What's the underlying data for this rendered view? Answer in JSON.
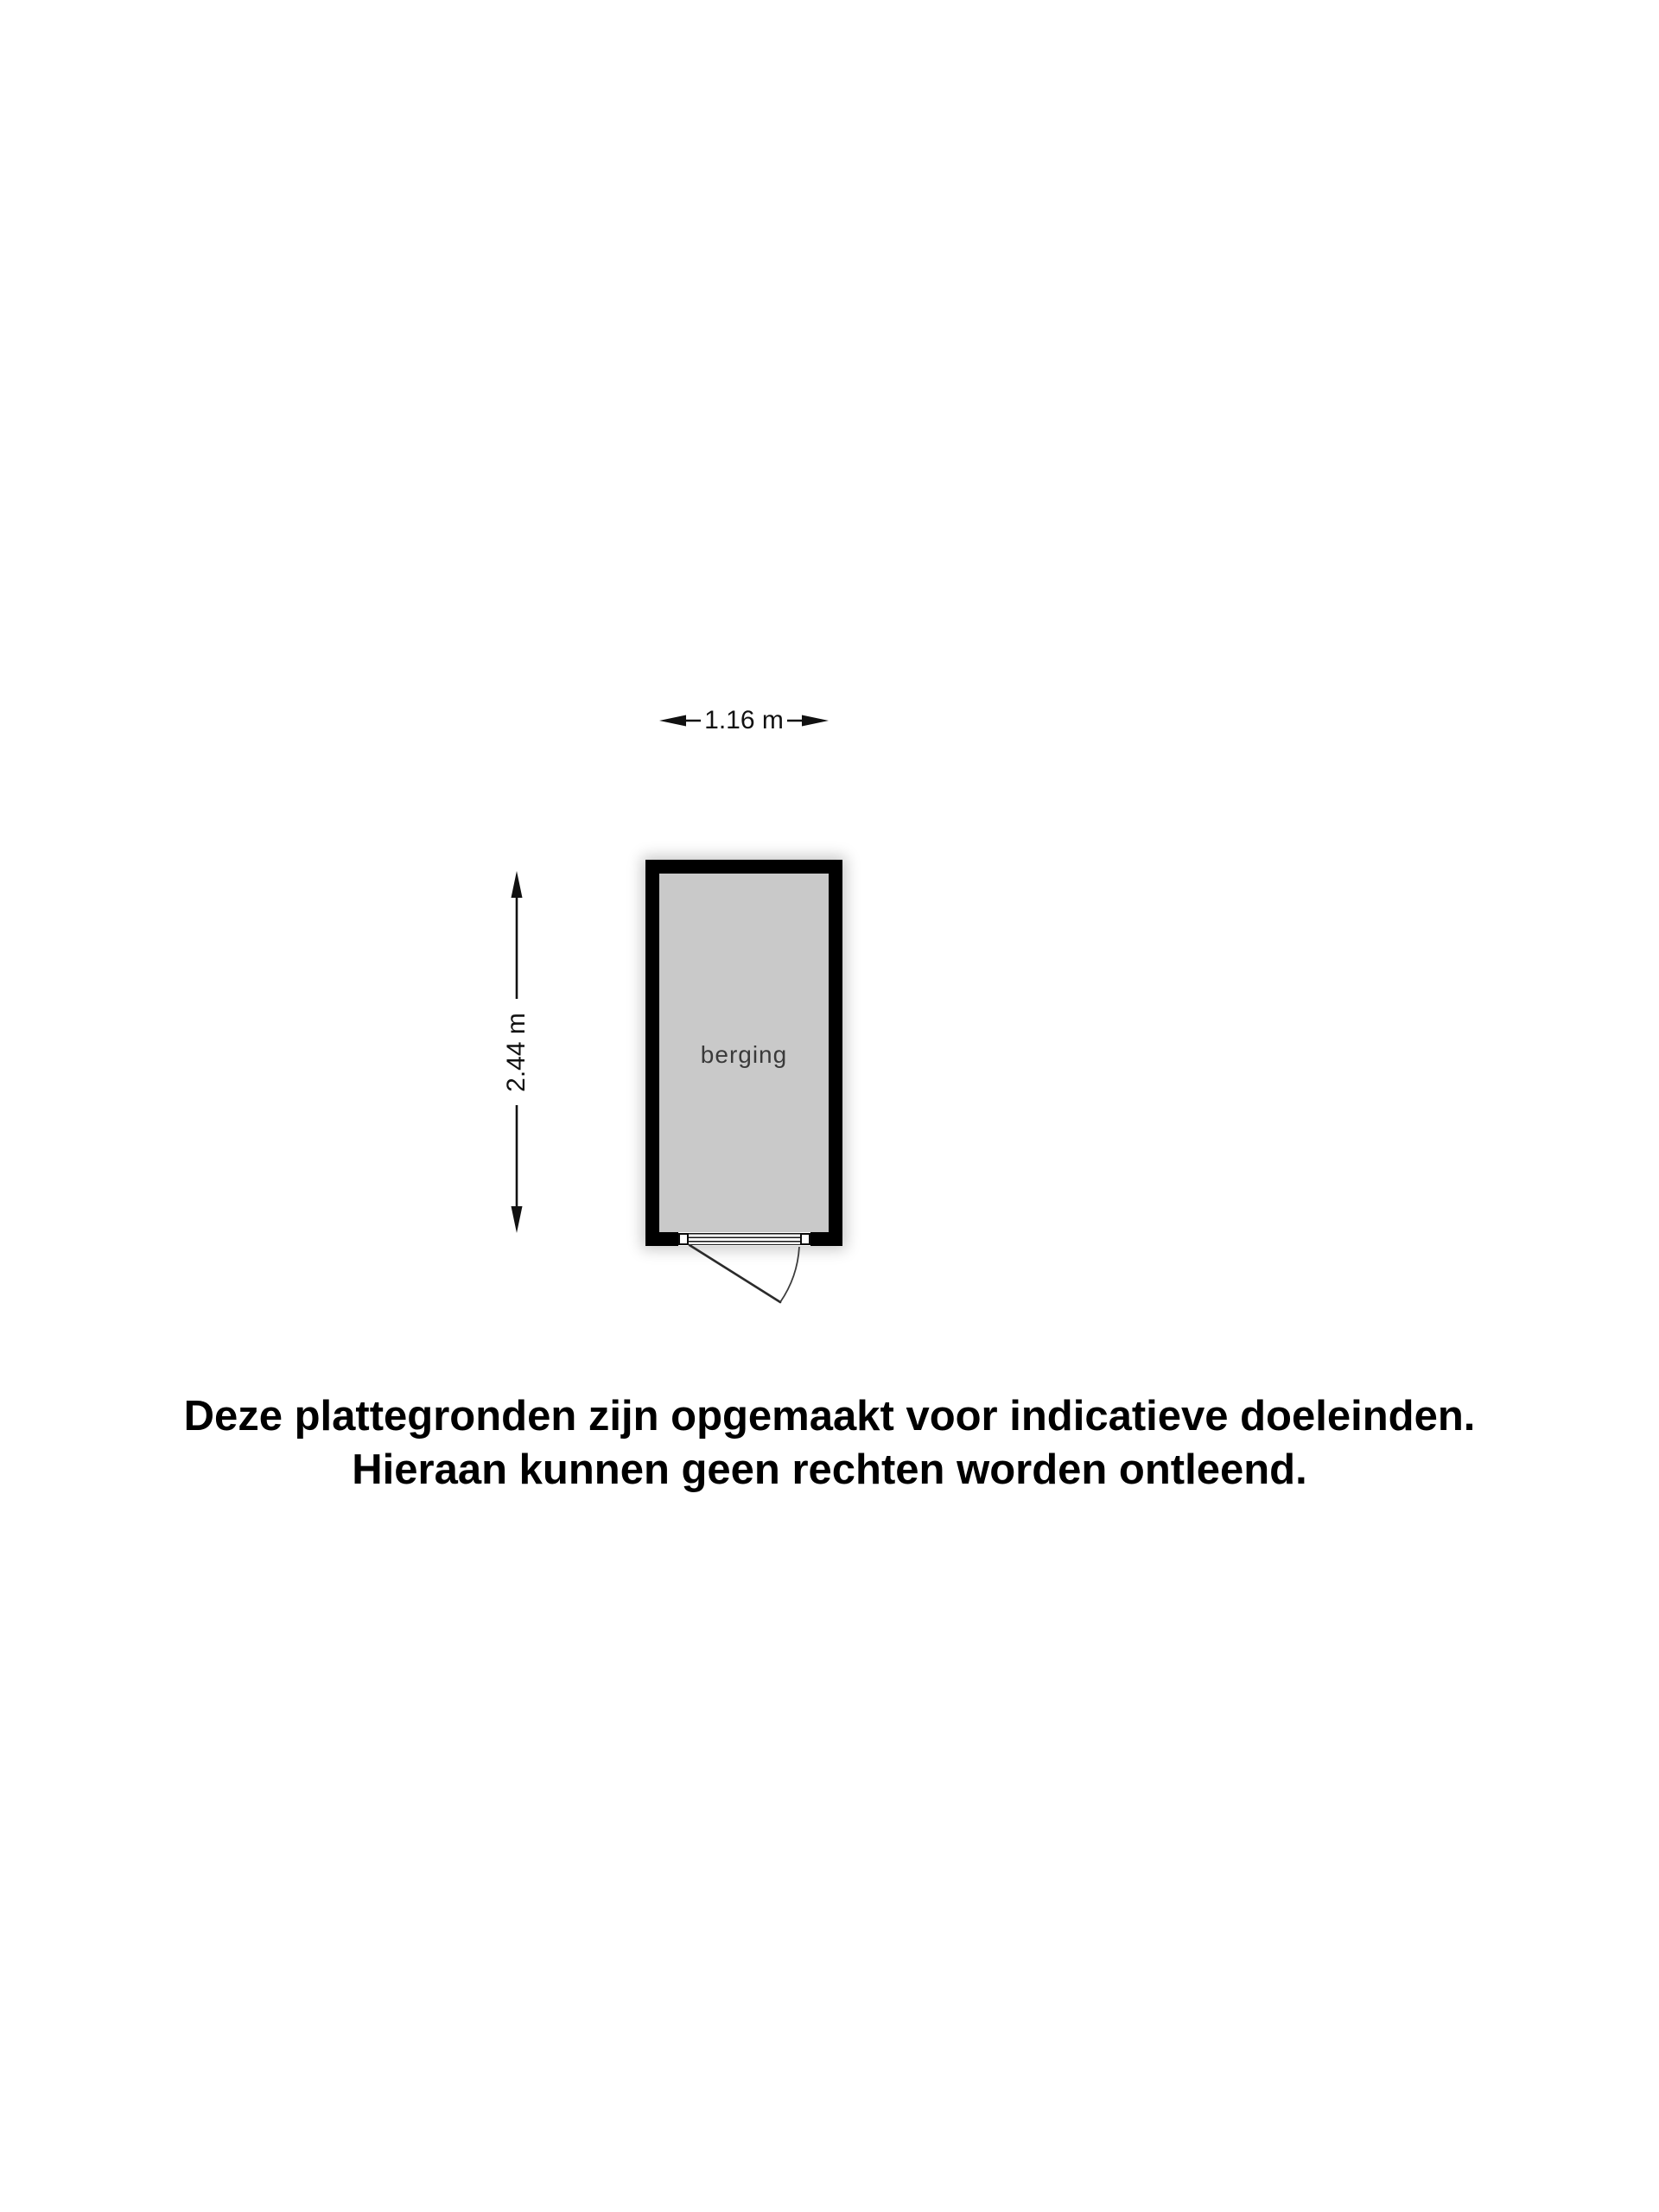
{
  "floorplan": {
    "room_label": "berging",
    "width_dimension": "1.16 m",
    "height_dimension": "2.44 m"
  },
  "disclaimer": {
    "line1": "Deze plattegronden zijn opgemaakt voor indicatieve doeleinden.",
    "line2": "Hieraan kunnen geen rechten worden ontleend."
  },
  "colors": {
    "wall": "#000000",
    "floor": "#c9c9c9",
    "room_label_text": "#3a3a3a",
    "dimension_ink": "#111111",
    "background": "#ffffff"
  }
}
